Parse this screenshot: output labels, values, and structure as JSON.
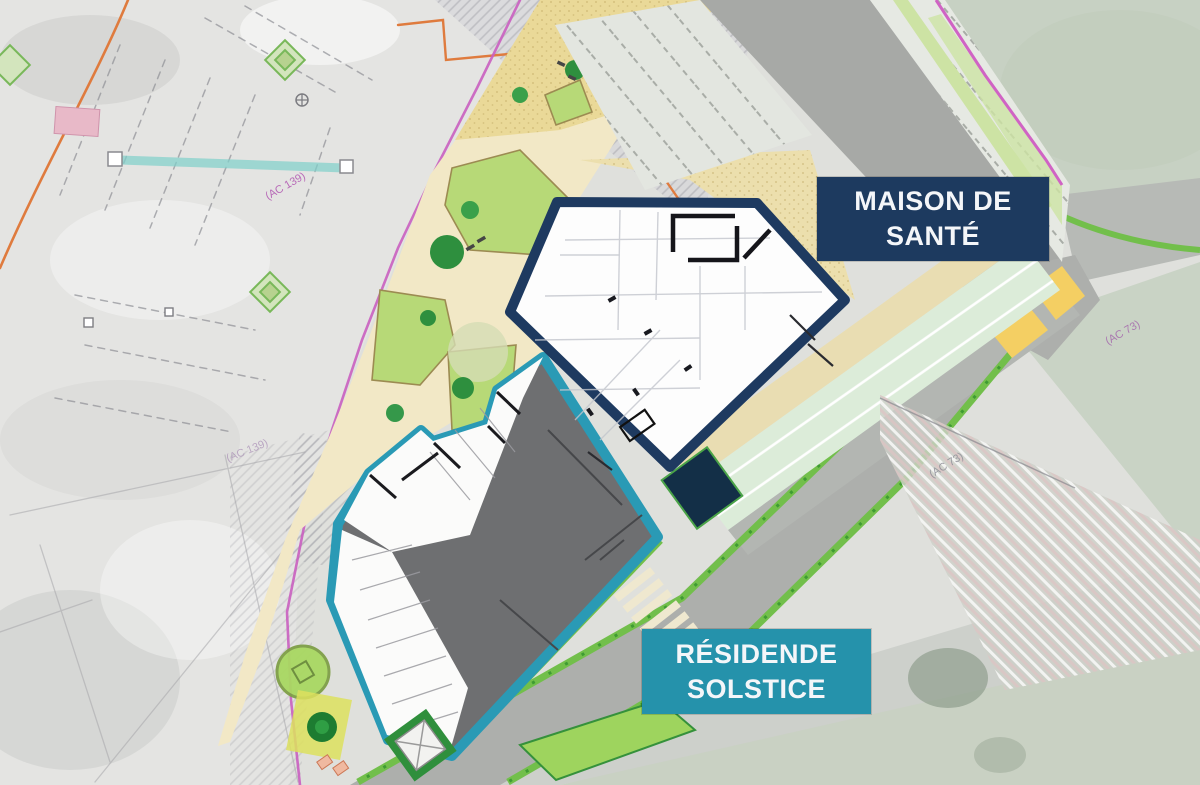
{
  "scene": {
    "kind": "architectural-site-plan",
    "description": "Site plan of a new development overlaid on a faded aerial/survey photo"
  },
  "labels": {
    "maison": {
      "line1": "MAISON DE",
      "line2": "SANTÉ",
      "bg": "#1d3a5f"
    },
    "residence": {
      "line1": "RÉSIDENDE",
      "line2": "SOLSTICE",
      "bg": "#2592ab"
    }
  },
  "parcel_labels": [
    {
      "text": "(AC 139)"
    },
    {
      "text": "(AC 139)"
    },
    {
      "text": "(AC 73)"
    },
    {
      "text": "(AC 73)"
    }
  ],
  "colors": {
    "maison_outline": "#1e3a60",
    "residence_outline": "#2a9ab5",
    "maison_label_bg": "#1d3a5f",
    "residence_label_bg": "#2592ab",
    "roof_gray": "#6e6f71",
    "road_gray": "#adafac",
    "plaza_cream": "#f2e8c6",
    "sand_path": "#ead998",
    "planting_green": "#b7d977",
    "tree_green": "#2e8f3e",
    "hedge_green": "#72bf4b",
    "mint_parking": "#dcecd9",
    "field_sage": "#c7d1c3",
    "boundary_magenta": "#c95fc0",
    "boundary_orange": "#df7b3e",
    "survey_teal": "#7fd0cb",
    "crosswalk_yellow": "#f4cf63"
  }
}
